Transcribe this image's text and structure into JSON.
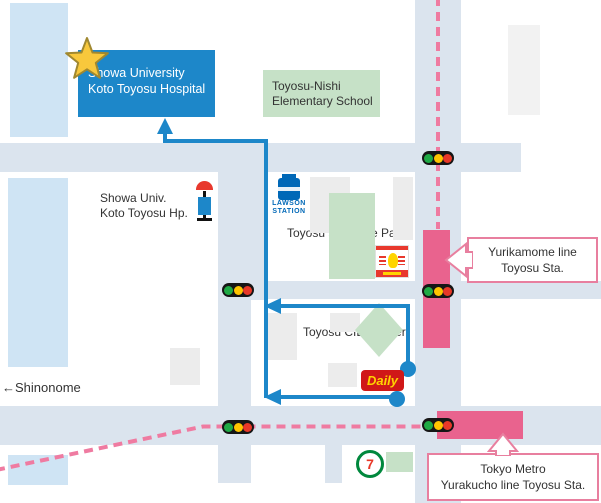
{
  "places": {
    "hospital": {
      "line1": "Showa University",
      "line2": "Koto Toyosu Hospital"
    },
    "school": {
      "line1": "Toyosu-Nishi",
      "line2": "Elementary School"
    },
    "bus_stop": {
      "line1": "Showa Univ.",
      "line2": "Koto Toyosu Hp."
    },
    "park": "Toyosu 5-Chome Park",
    "ciel_tower": "Toyosu CIEL Tower"
  },
  "roads": {
    "harumi": "Harumi-dori Ave.",
    "shinonome": "←Shinonome"
  },
  "exits": {
    "exit_6b": "Exit 6B",
    "exit_6a": "Exit 6A"
  },
  "callouts": {
    "yurikamome": {
      "line1": "Yurikamome line",
      "line2": "Toyosu Sta."
    },
    "tokyo_metro": {
      "line1": "Tokyo Metro",
      "line2": "Yurakucho line Toyosu Sta."
    }
  },
  "logos": {
    "lawson": {
      "line1": "LAWSON",
      "line2": "STATION"
    },
    "daily": "Daily",
    "seven_eleven": "7"
  },
  "icons": {
    "star": "star-icon (hospital location marker)",
    "bus_stop": "bus-stop-icon",
    "traffic_light": "traffic-light-icon (x5)",
    "market": "market-logo (red/white striped store sign)"
  },
  "colors": {
    "route_blue": "#1d87c9",
    "hospital_box_blue": "#1d87c9",
    "station_pink": "#e9638e",
    "rail_line_pink": "#ef7ba1",
    "callout_border_pink": "#e87f9f",
    "road_gray_blue": "#dbe4ee",
    "building_light_blue": "#cfe4f4",
    "building_gray": "#ececec",
    "green_area": "#c6e1c7",
    "star_yellow": "#f8c83c"
  }
}
